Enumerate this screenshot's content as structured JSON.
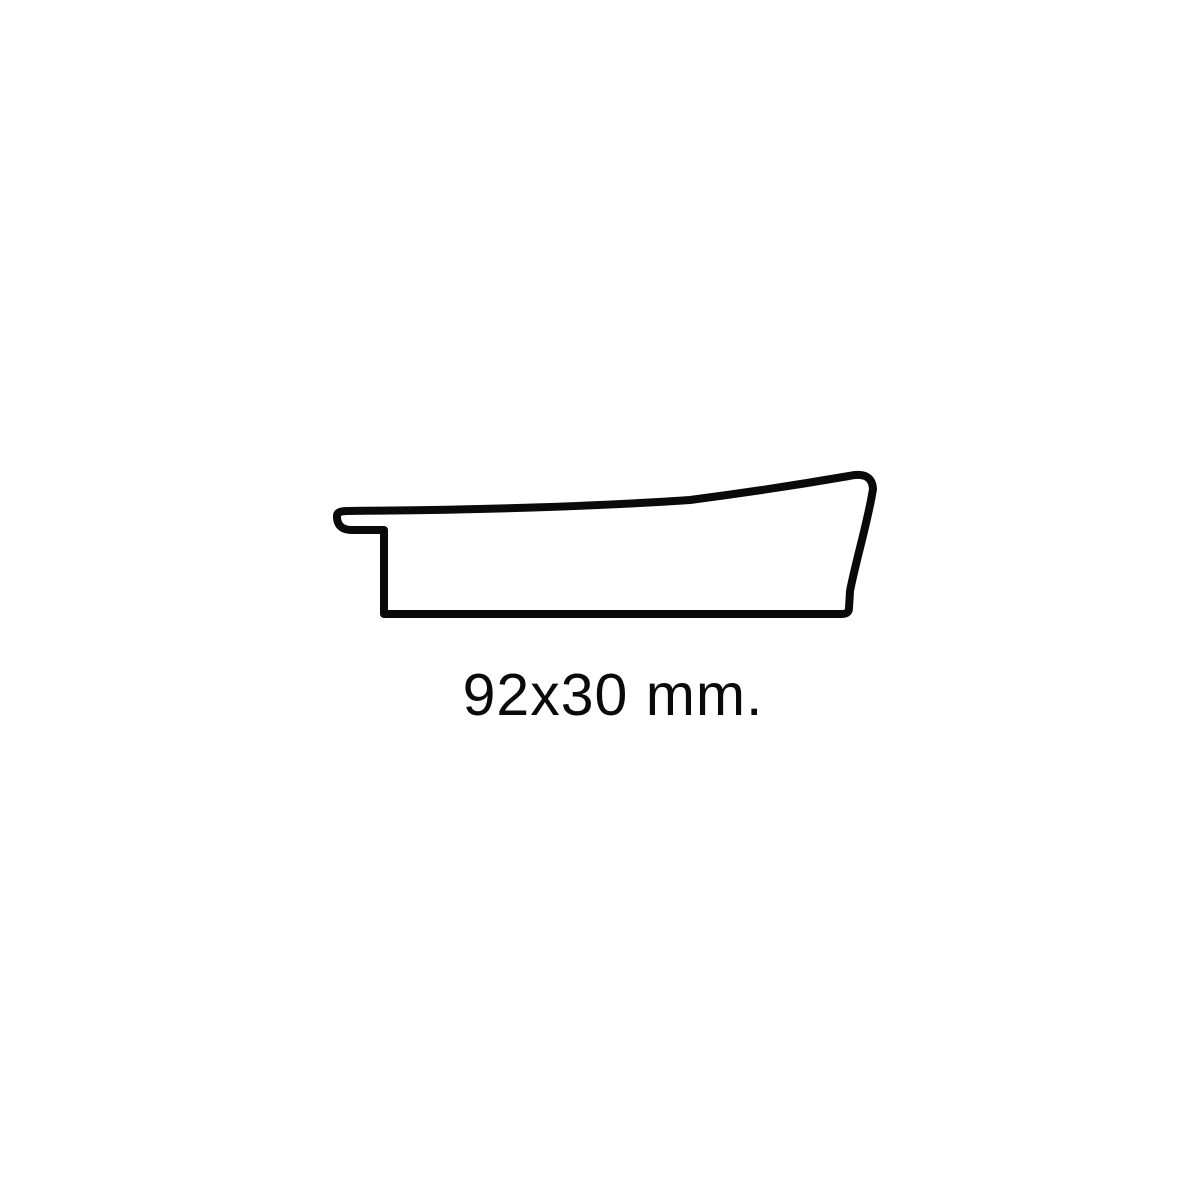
{
  "page": {
    "background_color": "#ffffff"
  },
  "diagram": {
    "type": "moulding-profile-cross-section",
    "caption": "92x30 mm.",
    "width_mm": "92",
    "height_mm": "30",
    "stroke_color": "#0a0a0a",
    "fill_color": "#ffffff",
    "stroke_width": "8",
    "profile_path": "M 347 511 C 480 510 600 506 690 500 C 760 491 820 481 849 476 Q 872 471 873 489 C 868 521 856 560 850 591 L 849 608 Q 849 614 842 614 L 384 614 L 384 530 L 352 530 Q 338 530 337 518 L 337 516 Q 337 511 347 511 Z"
  }
}
